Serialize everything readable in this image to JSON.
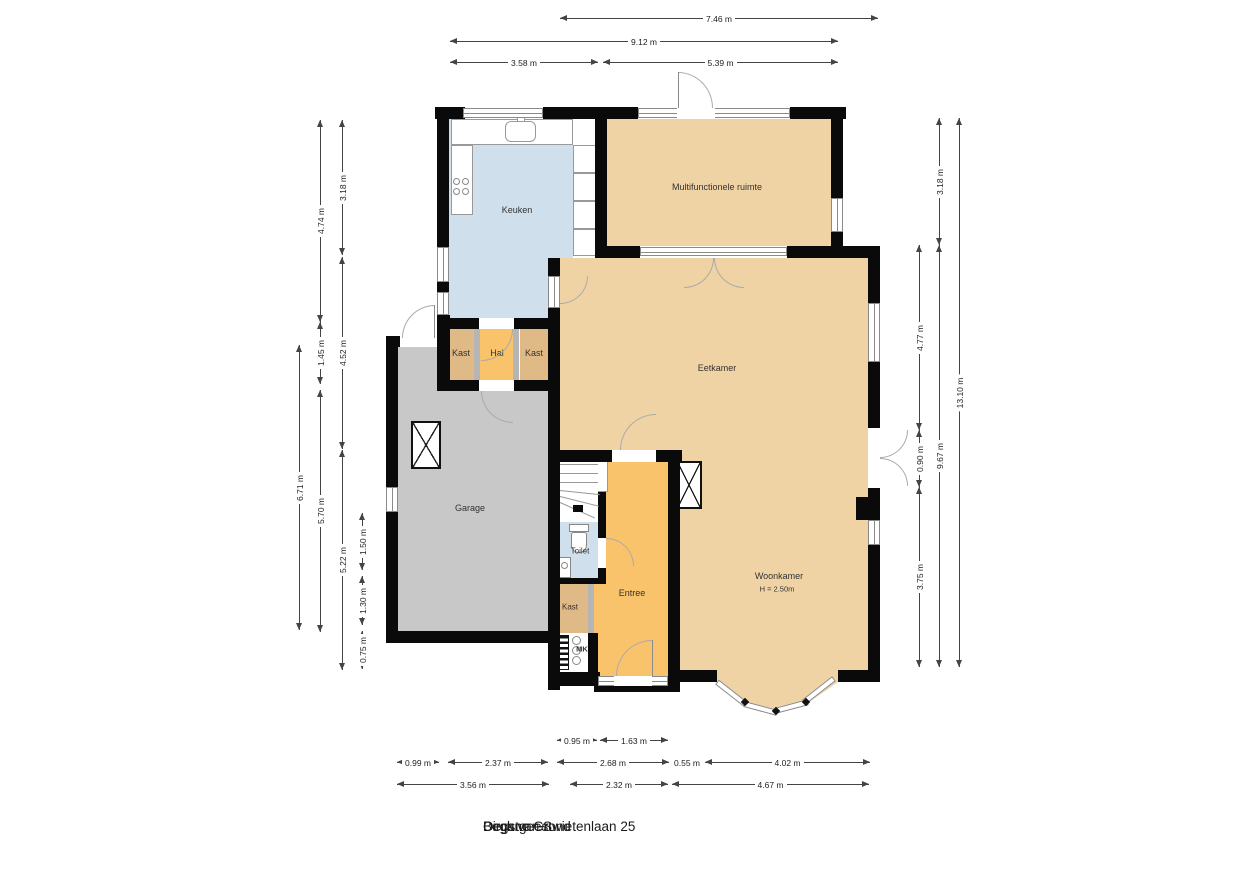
{
  "title": {
    "line1": "Begane Grond",
    "line2": "Dirck van Swietenlaan 25",
    "line3": "Oegstgeest"
  },
  "rooms": {
    "keuken": {
      "label": "Keuken"
    },
    "multifunctionele_ruimte": {
      "label": "Multifunctionele ruimte"
    },
    "eetkamer": {
      "label": "Eetkamer"
    },
    "hal": {
      "label": "Hal"
    },
    "kast_links": {
      "label": "Kast"
    },
    "kast_rechts": {
      "label": "Kast"
    },
    "garage": {
      "label": "Garage"
    },
    "toilet": {
      "label": "Toilet"
    },
    "entree": {
      "label": "Entree"
    },
    "kast_gang": {
      "label": "Kast"
    },
    "meterkast": {
      "label": "MK"
    },
    "woonkamer": {
      "label": "Woonkamer",
      "height": "H = 2.50m"
    }
  },
  "dimensions": {
    "top": [
      {
        "label": "7.46 m",
        "x": 560,
        "y": 18,
        "len": 318
      },
      {
        "label": "9.12 m",
        "x": 450,
        "y": 41,
        "len": 388
      },
      {
        "label": "3.58 m",
        "x": 450,
        "y": 62,
        "len": 148
      },
      {
        "label": "5.39 m",
        "x": 603,
        "y": 62,
        "len": 235
      }
    ],
    "bottom": [
      {
        "label": "0.95 m",
        "x": 557,
        "y": 740,
        "len": 40
      },
      {
        "label": "1.63 m",
        "x": 600,
        "y": 740,
        "len": 68
      },
      {
        "label": "0.99 m",
        "x": 397,
        "y": 762,
        "len": 42
      },
      {
        "label": "2.37 m",
        "x": 448,
        "y": 762,
        "len": 100
      },
      {
        "label": "2.68 m",
        "x": 557,
        "y": 762,
        "len": 112
      },
      {
        "label": "0.55 m",
        "x": 672,
        "y": 762,
        "len": 30
      },
      {
        "label": "4.02 m",
        "x": 705,
        "y": 762,
        "len": 165
      },
      {
        "label": "3.56 m",
        "x": 397,
        "y": 784,
        "len": 152
      },
      {
        "label": "2.32 m",
        "x": 570,
        "y": 784,
        "len": 98
      },
      {
        "label": "4.67 m",
        "x": 672,
        "y": 784,
        "len": 197
      }
    ],
    "left": [
      {
        "label": "4.74 m",
        "x": 320,
        "y": 120,
        "len": 202
      },
      {
        "label": "1.45 m",
        "x": 320,
        "y": 322,
        "len": 62
      },
      {
        "label": "3.18 m",
        "x": 342,
        "y": 120,
        "len": 135
      },
      {
        "label": "4.52 m",
        "x": 342,
        "y": 257,
        "len": 192
      },
      {
        "label": "6.71 m",
        "x": 299,
        "y": 345,
        "len": 285
      },
      {
        "label": "5.70 m",
        "x": 320,
        "y": 390,
        "len": 242
      },
      {
        "label": "5.22 m",
        "x": 342,
        "y": 450,
        "len": 220
      },
      {
        "label": "1.50 m",
        "x": 362,
        "y": 513,
        "len": 57
      },
      {
        "label": "1.30 m",
        "x": 362,
        "y": 576,
        "len": 49
      },
      {
        "label": "0.75 m",
        "x": 362,
        "y": 631,
        "len": 38
      }
    ],
    "right": [
      {
        "label": "3.18 m",
        "x": 939,
        "y": 118,
        "len": 127
      },
      {
        "label": "9.67 m",
        "x": 939,
        "y": 245,
        "len": 422
      },
      {
        "label": "4.77 m",
        "x": 919,
        "y": 245,
        "len": 185
      },
      {
        "label": "0.90 m",
        "x": 919,
        "y": 430,
        "len": 57
      },
      {
        "label": "3.75 m",
        "x": 919,
        "y": 487,
        "len": 180
      },
      {
        "label": "13.10 m",
        "x": 959,
        "y": 118,
        "len": 549
      }
    ]
  },
  "colors": {
    "wall": "#0a0a0a",
    "tan": "#f0d3a5",
    "orange": "#f9c36b",
    "tan_dark": "#dfba86",
    "blue": "#cfdfeb",
    "gray": "#c8c8c8",
    "line": "#444444",
    "frame": "#8a8a8a",
    "arc": "#aaaaaa",
    "label": "#333333"
  }
}
